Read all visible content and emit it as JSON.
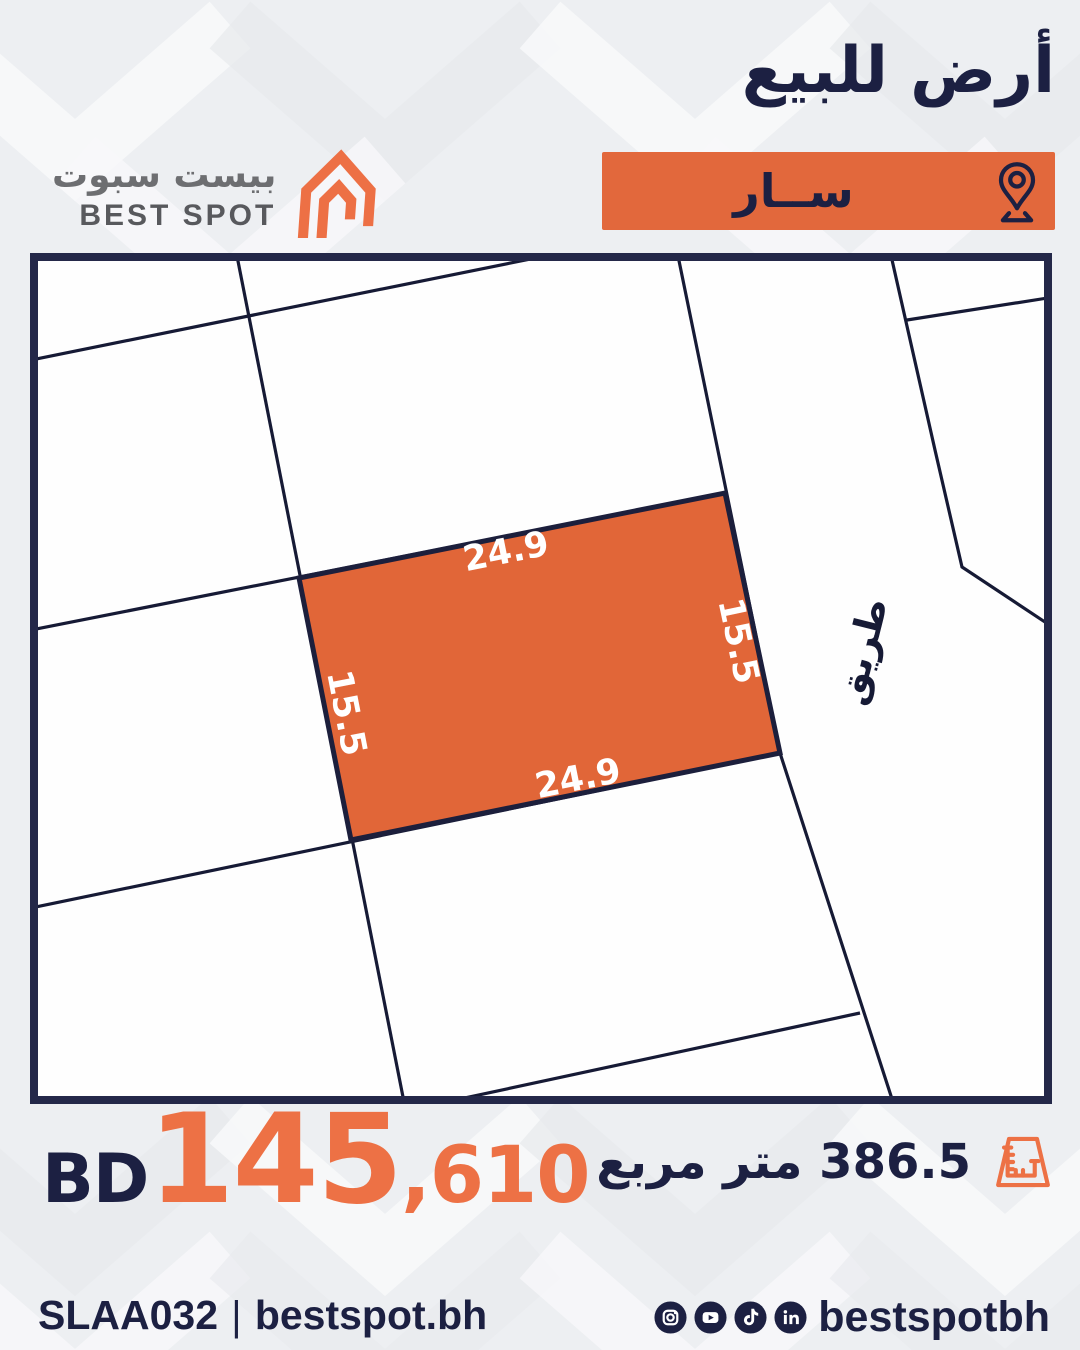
{
  "header": {
    "title": "أرض للبيع",
    "banner_label": "ســار"
  },
  "brand": {
    "name_ar": "بيست سبوت",
    "name_en": "BEST SPOT"
  },
  "map": {
    "road_label": "طريق",
    "plot_dimensions": {
      "top": "24.9",
      "bottom": "24.9",
      "left": "15.5",
      "right": "15.5"
    }
  },
  "price": {
    "currency": "BD",
    "amount_main": "145",
    "amount_rest": ",610"
  },
  "area": {
    "text": "386.5 متر مربع"
  },
  "footer": {
    "ref": "SLAA032",
    "separator": "|",
    "website": "bestspot.bh",
    "handle": "bestspotbh",
    "social_icons": [
      "instagram-icon",
      "youtube-icon",
      "tiktok-icon",
      "linkedin-icon"
    ]
  },
  "colors": {
    "navy": "#1c2042",
    "map_border": "#242849",
    "map_line": "#161a35",
    "banner_orange": "#e2683c",
    "plot_orange": "#e16638",
    "price_orange": "#ed7145",
    "logo_orange": "#ed7045",
    "logo_gray": "#6d6e71",
    "background": "#edeff2"
  }
}
